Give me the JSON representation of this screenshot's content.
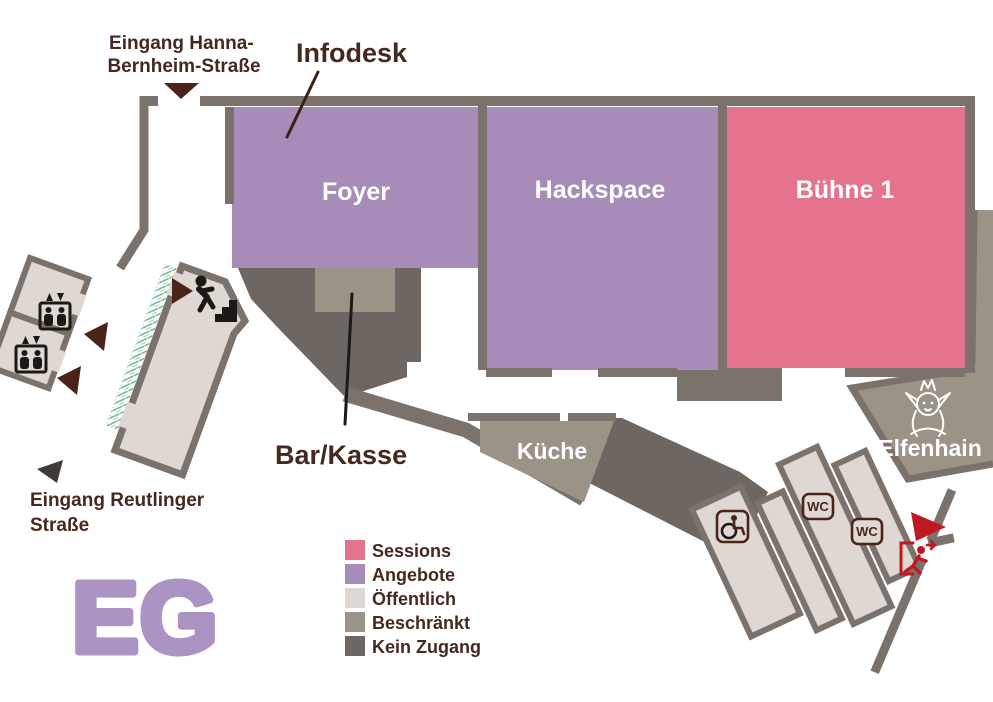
{
  "floor": {
    "label": "EG"
  },
  "colors": {
    "wall": "#7b736b",
    "sessions": "#e5738e",
    "angebote": "#a78cba",
    "oeffentlich": "#ded7d2",
    "beschraenkt": "#9a9386",
    "kein_zugang": "#6e6660",
    "label_text": "#46281e",
    "arrow_brown": "#4a2418",
    "exit_red": "#bf1a24",
    "vegetation": "#76b694",
    "floor_letters": "#ab93c4",
    "room_label_text": "#ffffff"
  },
  "rooms": {
    "foyer": {
      "label": "Foyer"
    },
    "hackspace": {
      "label": "Hackspace"
    },
    "buehne1": {
      "label": "Bühne 1"
    },
    "kueche": {
      "label": "Küche"
    },
    "elfenhain": {
      "label": "Elfenhain"
    }
  },
  "annotations": {
    "infodesk": {
      "label": "Infodesk"
    },
    "bar_kasse": {
      "label": "Bar/Kasse"
    }
  },
  "entrances": {
    "hanna": {
      "line1": "Eingang Hanna-",
      "line2": "Bernheim-Straße"
    },
    "reutlinger": {
      "line1": "Eingang Reutlinger",
      "line2": "Straße"
    }
  },
  "badges": {
    "wc_label": "WC"
  },
  "legend": {
    "items": [
      {
        "label": "Sessions",
        "color": "#e5738e"
      },
      {
        "label": "Angebote",
        "color": "#a78cba"
      },
      {
        "label": "Öffentlich",
        "color": "#ded7d2"
      },
      {
        "label": "Beschränkt",
        "color": "#9a9386"
      },
      {
        "label": "Kein Zugang",
        "color": "#6e6660"
      }
    ]
  }
}
